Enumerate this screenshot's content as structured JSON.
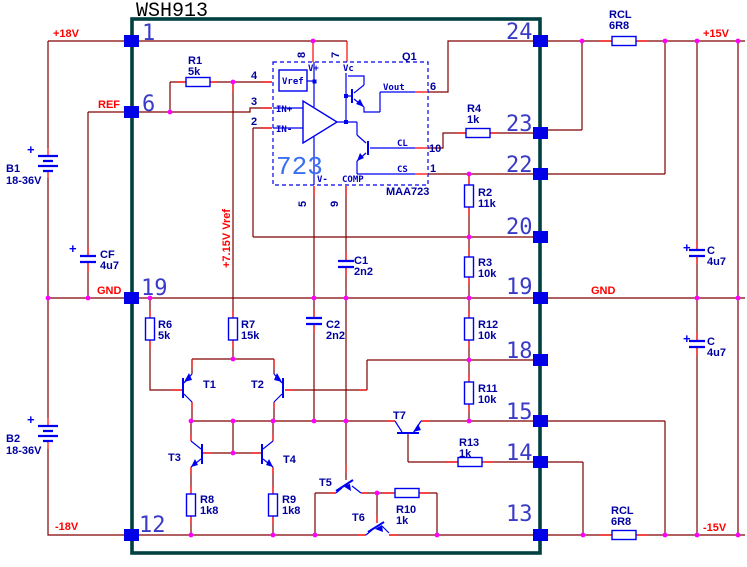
{
  "title": "WSH913",
  "nets": {
    "plus18": "+18V",
    "ref": "REF",
    "gnd_left": "GND",
    "gnd_right": "GND",
    "plus15": "+15V",
    "minus15": "-15V",
    "minus18": "-18V",
    "vref_rail": "+7.15V Vref"
  },
  "module_pins": {
    "p1": "1",
    "p6": "6",
    "p19l": "19",
    "p12": "12",
    "p24": "24",
    "p23": "23",
    "p22": "22",
    "p20": "20",
    "p19r": "19",
    "p18": "18",
    "p15": "15",
    "p14": "14",
    "p13": "13"
  },
  "ic": {
    "big_label": "723",
    "part": "MAA723",
    "q1": "Q1",
    "vref_box": "Vref",
    "v_plus": "V+",
    "vc": "Vc",
    "in_plus": "IN+",
    "in_minus": "IN-",
    "v_minus": "V-",
    "comp": "COMP",
    "vout": "Vout",
    "cl": "CL",
    "cs": "CS",
    "pin4": "4",
    "pin3": "3",
    "pin2": "2",
    "pin8": "8",
    "pin7": "7",
    "pin5": "5",
    "pin9": "9",
    "pin6": "6",
    "pin10": "10",
    "pin1": "1"
  },
  "resistors": {
    "r1": {
      "name": "R1",
      "value": "5k"
    },
    "r2": {
      "name": "R2",
      "value": "11k"
    },
    "r3": {
      "name": "R3",
      "value": "10k"
    },
    "r4": {
      "name": "R4",
      "value": "1k"
    },
    "r6": {
      "name": "R6",
      "value": "5k"
    },
    "r7": {
      "name": "R7",
      "value": "15k"
    },
    "r8": {
      "name": "R8",
      "value": "1k8"
    },
    "r9": {
      "name": "R9",
      "value": "1k8"
    },
    "r10": {
      "name": "R10",
      "value": "1k"
    },
    "r11": {
      "name": "R11",
      "value": "10k"
    },
    "r12": {
      "name": "R12",
      "value": "10k"
    },
    "r13": {
      "name": "R13",
      "value": "1k"
    },
    "rcl_top": {
      "name": "RCL",
      "value": "6R8"
    },
    "rcl_bottom": {
      "name": "RCL",
      "value": "6R8"
    }
  },
  "capacitors": {
    "c1": {
      "name": "C1",
      "value": "2n2"
    },
    "c2": {
      "name": "C2",
      "value": "2n2"
    },
    "cf": {
      "name": "CF",
      "value": "4u7",
      "polarity": "+"
    },
    "c_top": {
      "name": "C",
      "value": "4u7",
      "polarity": "+"
    },
    "c_bottom": {
      "name": "C",
      "value": "4u7",
      "polarity": "+"
    }
  },
  "batteries": {
    "b1": {
      "name": "B1",
      "value": "18-36V",
      "polarity": "+"
    },
    "b2": {
      "name": "B2",
      "value": "18-36V",
      "polarity": "+"
    }
  },
  "transistors": {
    "t1": "T1",
    "t2": "T2",
    "t3": "T3",
    "t4": "T4",
    "t5": "T5",
    "t6": "T6",
    "t7": "T7"
  },
  "colors": {
    "wire": "#800000",
    "lead": "#ff0000",
    "junction": "#ff00ff",
    "symbol": "#0000f0",
    "label": "#0000a0",
    "net_label": "#ff0000",
    "module_border": "#004040",
    "pin_square": "#0000e8",
    "ic_accent": "#3a6ff2"
  }
}
